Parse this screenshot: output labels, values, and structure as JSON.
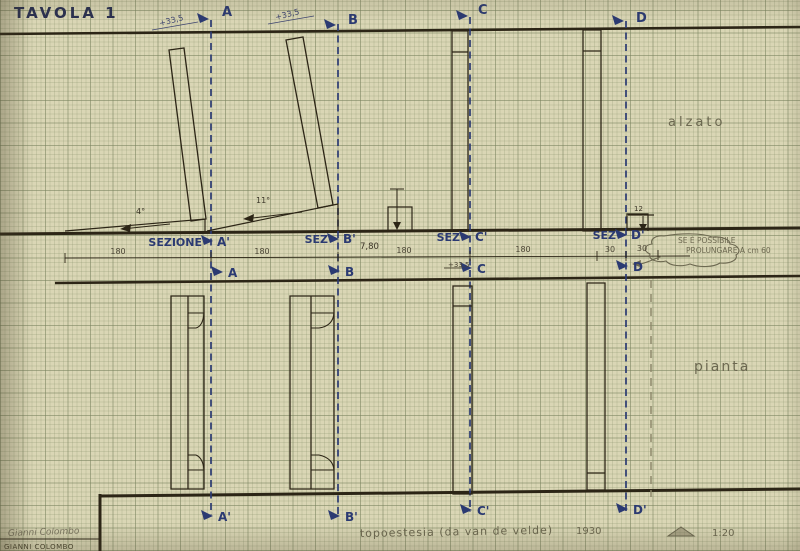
{
  "title": "TAVOLA 1",
  "drawing": {
    "elevation_label": "alzato",
    "plan_label": "pianta",
    "top_markers": [
      {
        "letter": "A",
        "level": "+33,5"
      },
      {
        "letter": "B",
        "level": "+33,5"
      },
      {
        "letter": "C",
        "level": ""
      },
      {
        "letter": "D",
        "level": ""
      }
    ],
    "section_labels": [
      {
        "prefix": "SEZIONE",
        "letter": "A'"
      },
      {
        "prefix": "SEZ",
        "letter": "B'"
      },
      {
        "prefix": "SEZ",
        "letter": "C'"
      },
      {
        "prefix": "SEZ",
        "letter": "D'"
      }
    ],
    "lower_markers": [
      {
        "letter": "A"
      },
      {
        "letter": "B"
      },
      {
        "letter": "C"
      },
      {
        "letter": "D"
      }
    ],
    "bottom_markers": [
      {
        "letter": "A'"
      },
      {
        "letter": "B'"
      },
      {
        "letter": "C'"
      },
      {
        "letter": "D'"
      }
    ],
    "dims": {
      "total": "7,80",
      "seg1": "180",
      "seg2": "180",
      "seg3": "180",
      "seg4": "180",
      "d_seg1": "30",
      "d_seg2": "30",
      "c_offset": "+33,5",
      "step": "12",
      "slope_a": "4°",
      "slope_b": "11°"
    },
    "note_line1": "SE È POSSIBILE",
    "note_line2": "PROLUNGARE A cm 60"
  },
  "footer": {
    "caption": "topoestesia (da van de velde)",
    "year": "1930",
    "scale": "1:20",
    "signature": "Gianni Colombo",
    "name_printed": "GIANNI COLOMBO"
  },
  "colors": {
    "paper": "#dad6b5",
    "ink": "#2c2516",
    "blue": "#2b3a72",
    "pencil": "#6c6850"
  }
}
